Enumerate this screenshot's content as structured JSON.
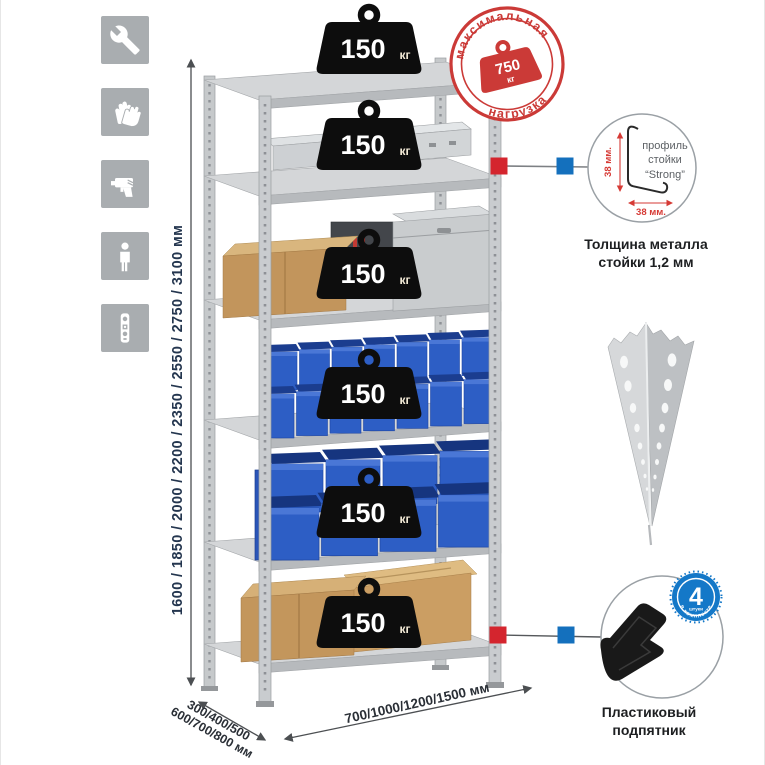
{
  "sidebar": {
    "icons": [
      {
        "label": "wrench"
      },
      {
        "label": "gloves"
      },
      {
        "label": "drill"
      },
      {
        "label": "person"
      },
      {
        "label": "level"
      }
    ]
  },
  "dimensions": {
    "height": "1600 / 1850 / 2000 / 2200 / 2350 / 2550 / 2750 / 3100 мм",
    "depth_line1": "300/400/500",
    "depth_line2": "600/700/800 мм",
    "width": "700/1000/1200/1500 мм"
  },
  "stamp": {
    "arc_top": "максимальная",
    "arc_bottom": "нагрузка",
    "value": "750",
    "unit": "кг"
  },
  "shelves": {
    "loads": [
      {
        "value": "150",
        "unit": "кг"
      },
      {
        "value": "150",
        "unit": "кг"
      },
      {
        "value": "150",
        "unit": "кг"
      },
      {
        "value": "150",
        "unit": "кг"
      },
      {
        "value": "150",
        "unit": "кг"
      },
      {
        "value": "150",
        "unit": "кг"
      }
    ]
  },
  "profile_detail": {
    "text_line1": "профиль",
    "text_line2": "стойки",
    "text_line3": "“Strong”",
    "dim_vertical": "38 мм.",
    "dim_horizontal": "38 мм.",
    "caption_line1": "Толщина металла",
    "caption_line2": "стойки 1,2 мм"
  },
  "foot_detail": {
    "badge_number": "4",
    "badge_sub": "штуки",
    "badge_arc": "в комплекте",
    "caption_line1": "Пластиковый",
    "caption_line2": "подпятник"
  },
  "colors": {
    "accent_red": "#d0342f",
    "accent_blue": "#1470bd",
    "dimension_text": "#24364f",
    "bin_blue": "#2d5ec5",
    "cardboard": "#c2955c",
    "metal_light": "#d2d4d6",
    "icon_bg": "#a9adb0",
    "weight_black": "#0d0d0d"
  }
}
